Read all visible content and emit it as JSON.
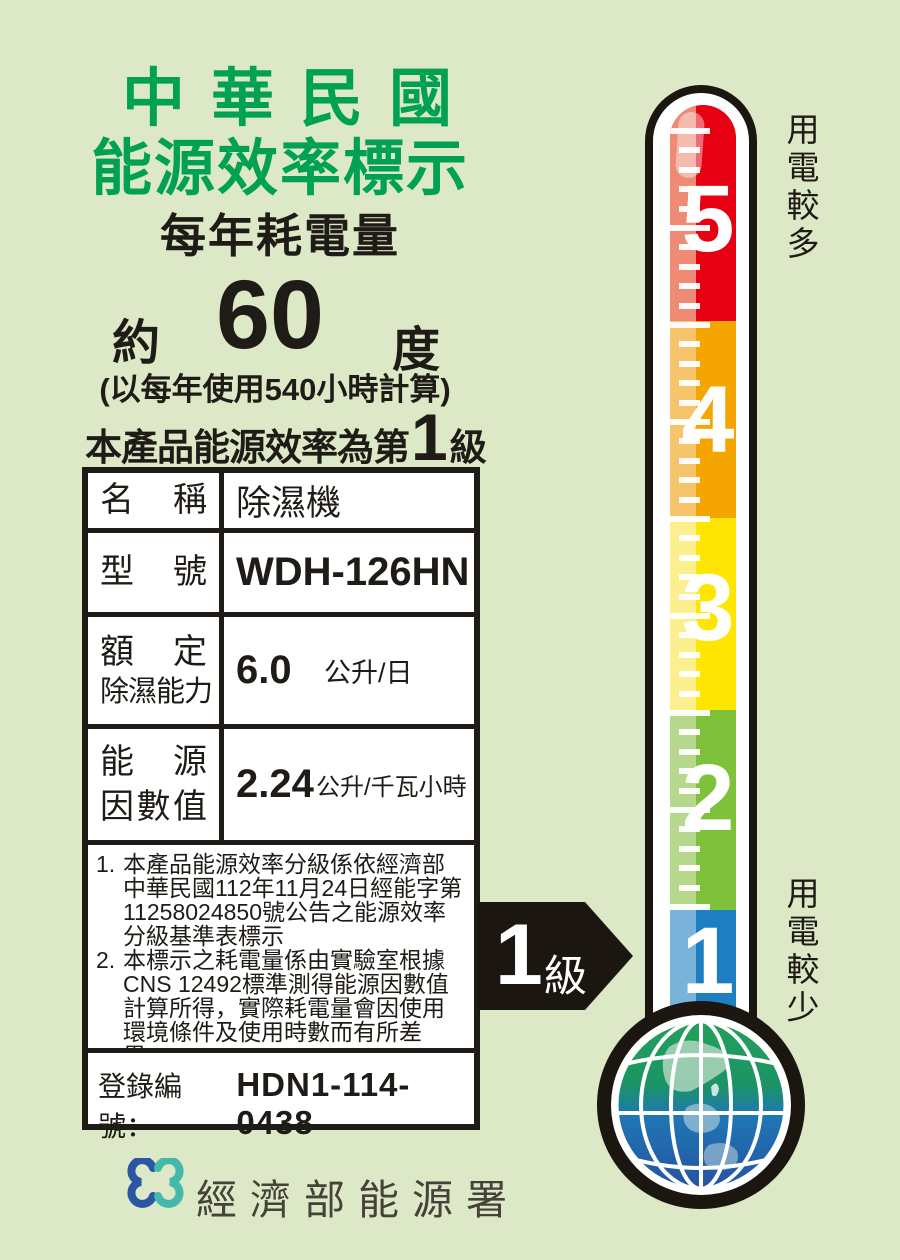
{
  "label": {
    "title_line1": "中華民國",
    "title_line2": "能源效率標示",
    "subtitle": "每年耗電量",
    "consumption": {
      "prefix": "約",
      "value": "60",
      "unit": "度",
      "basis": "(以每年使用540小時計算)"
    },
    "grade_sentence": {
      "prefix": "本產品能源效率為第",
      "grade": "1",
      "suffix": "級"
    },
    "table": {
      "rows": [
        {
          "label_lines": [
            "名稱"
          ],
          "value": "除濕機",
          "style": "cjk"
        },
        {
          "label_lines": [
            "型號"
          ],
          "value": "WDH-126HN",
          "style": "model"
        },
        {
          "label_lines": [
            "額定",
            "除濕能力"
          ],
          "value": "6.0",
          "unit": "公升/日",
          "style": "num"
        },
        {
          "label_lines": [
            "能源",
            "因數值"
          ],
          "value": "2.24",
          "unit": "公升/千瓦小時",
          "style": "num-small"
        }
      ]
    },
    "notes": [
      {
        "num": "1.",
        "text": "本產品能源效率分級係依經濟部中華民國112年11月24日經能字第11258024850號公告之能源效率分級基準表標示"
      },
      {
        "num": "2.",
        "text": "本標示之耗電量係由實驗室根據CNS 12492標準測得能源因數值計算所得，實際耗電量會因使用環境條件及使用時數而有所差異。"
      }
    ],
    "registration": {
      "label": "登錄編號：",
      "value": "HDN1-114-0438"
    }
  },
  "footer": {
    "agency": "經濟部能源署"
  },
  "thermometer": {
    "scale": [
      {
        "grade": "5",
        "color": "#e60012",
        "tint": "#ef8a75"
      },
      {
        "grade": "4",
        "color": "#f5a500",
        "tint": "#f6c46b"
      },
      {
        "grade": "3",
        "color": "#ffe602",
        "tint": "#fbf08d"
      },
      {
        "grade": "2",
        "color": "#7fc13b",
        "tint": "#b5d88c"
      },
      {
        "grade": "1",
        "color": "#1d7ec2",
        "tint": "#79b3d9"
      }
    ],
    "top_label": "用電較多",
    "bottom_label": "用電較少",
    "arrow_label": {
      "number": "1",
      "suffix": "級"
    }
  },
  "colors": {
    "background": "#dce8c6",
    "title_green": "#00a152",
    "print_black": "#1f1b16",
    "logo_blue": "#2b55a5",
    "logo_teal": "#43b9ab",
    "globe_green": "#25a05c",
    "globe_blue": "#25549f"
  }
}
